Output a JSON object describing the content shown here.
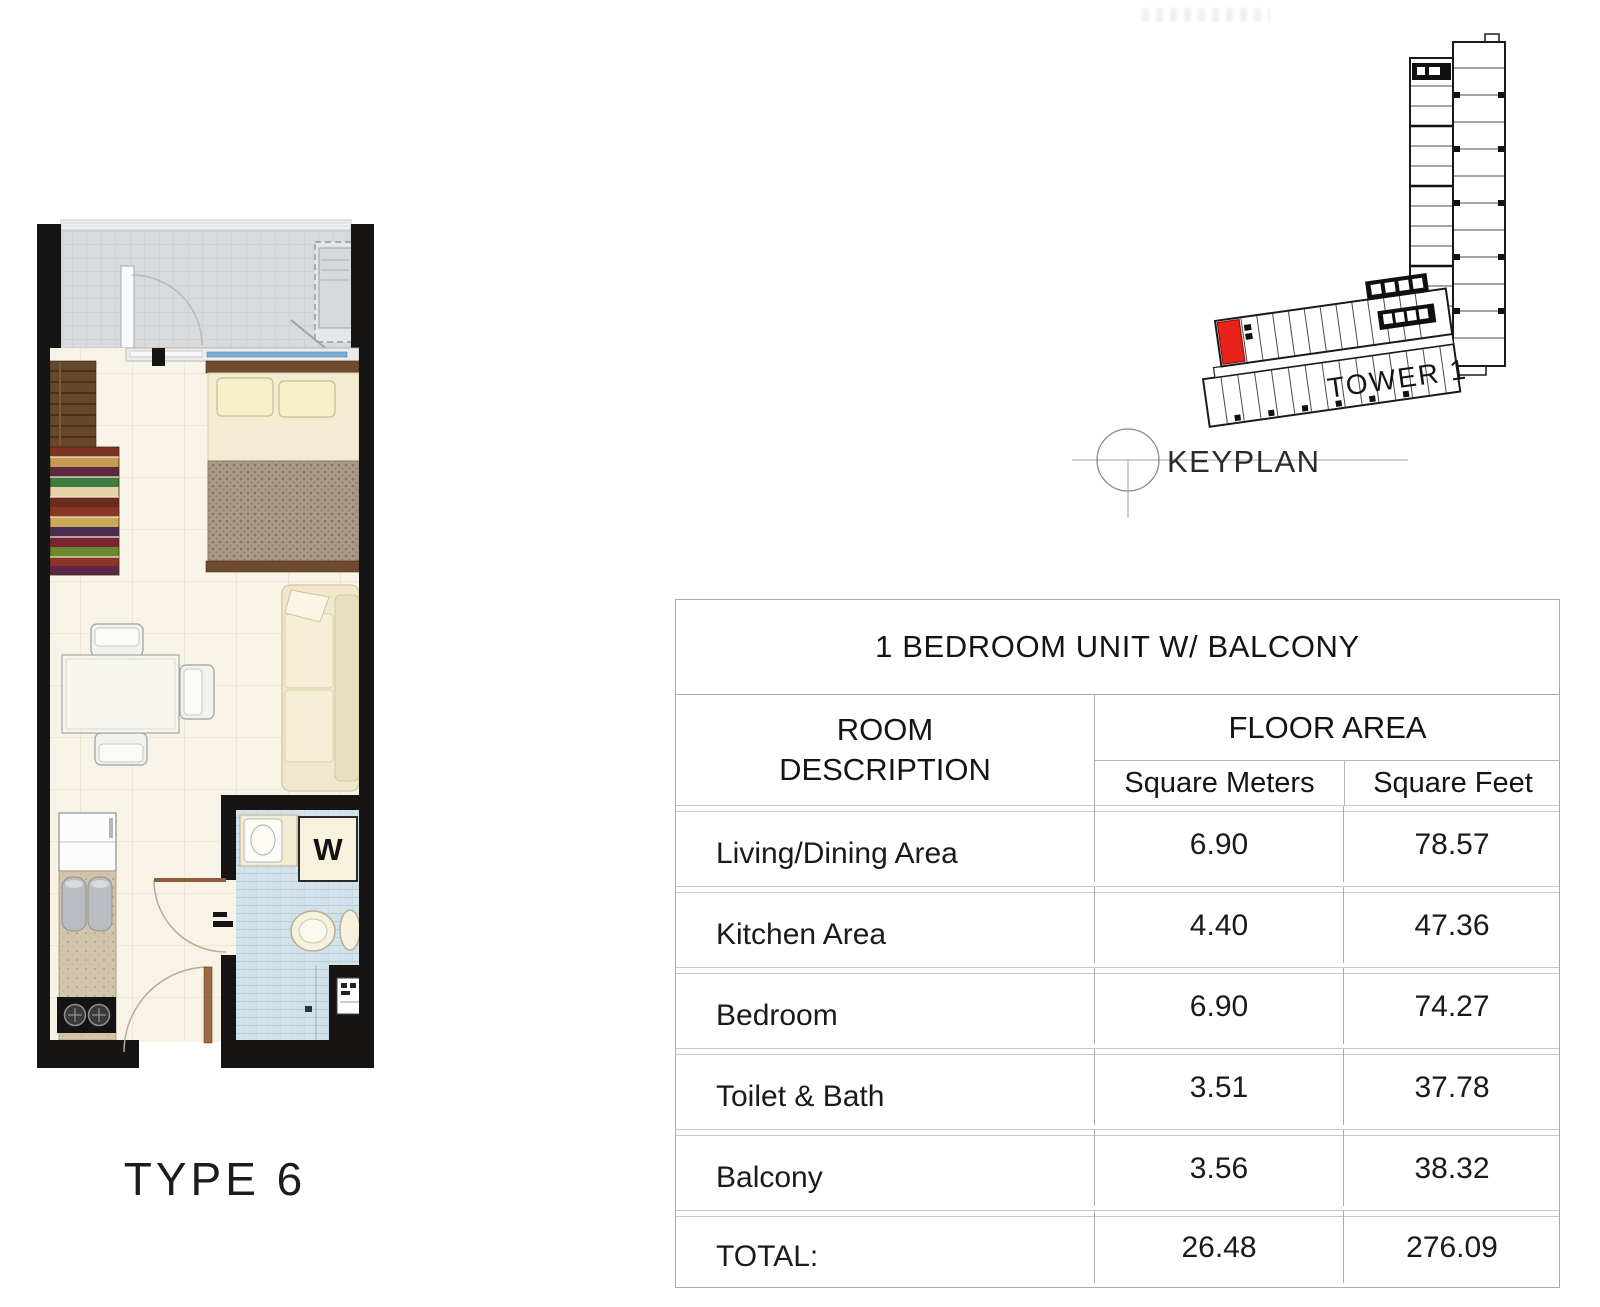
{
  "floorplan": {
    "type_label": "TYPE 6",
    "washer_label": "W",
    "colors": {
      "wall": "#171513",
      "balcony_tile": "#d8dbdd",
      "unit_floor": "#f8f3e7",
      "bath_tile": "#d3e2ea",
      "wood": "#66482c",
      "bed": "#f3ecd2",
      "glass_door": "#79b0d4"
    }
  },
  "keyplan": {
    "title": "KEYPLAN",
    "tower_label": "TOWER 1",
    "highlight_color": "#e8231c"
  },
  "area_table": {
    "title": "1 BEDROOM UNIT W/ BALCONY",
    "headers": {
      "room": "ROOM DESCRIPTION",
      "floor_area": "FLOOR AREA",
      "sqm": "Square Meters",
      "sqft": "Square Feet"
    },
    "rows": [
      {
        "room": "Living/Dining Area",
        "sqm": "6.90",
        "sqft": "78.57"
      },
      {
        "room": "Kitchen Area",
        "sqm": "4.40",
        "sqft": "47.36"
      },
      {
        "room": "Bedroom",
        "sqm": "6.90",
        "sqft": "74.27"
      },
      {
        "room": "Toilet & Bath",
        "sqm": "3.51",
        "sqft": "37.78"
      },
      {
        "room": "Balcony",
        "sqm": "3.56",
        "sqft": "38.32"
      }
    ],
    "total": {
      "room": "TOTAL:",
      "sqm": "26.48",
      "sqft": "276.09"
    }
  }
}
